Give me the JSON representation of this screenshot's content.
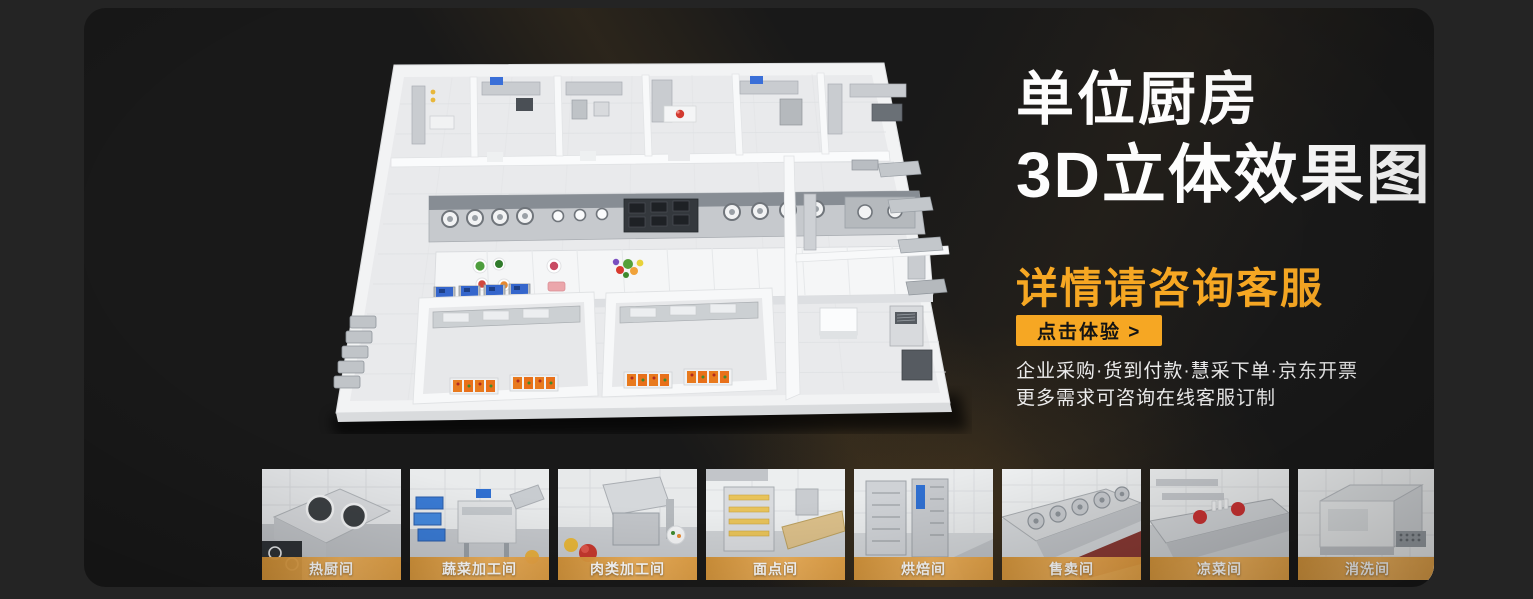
{
  "hero": {
    "title_line1": "单位厨房",
    "title_line2": "3D立体效果图",
    "subtitle": "详情请咨询客服",
    "cta_label": "点击体验 >",
    "info_line1": "企业采购·货到付款·慧采下单·京东开票",
    "info_line2": "更多需求可咨询在线客服订制"
  },
  "rooms": [
    {
      "label": "热厨间"
    },
    {
      "label": "蔬菜加工间"
    },
    {
      "label": "肉类加工间"
    },
    {
      "label": "面点间"
    },
    {
      "label": "烘焙间"
    },
    {
      "label": "售卖间"
    },
    {
      "label": "凉菜间"
    },
    {
      "label": "消洗间"
    }
  ],
  "colors": {
    "accent_orange": "#F6A723",
    "panel_background": "#191919",
    "outer_background": "#242424",
    "cta_text": "#141414",
    "label_band_start": "#D39134",
    "label_band_end": "#F2B054",
    "title_text": "#FDFDFD",
    "body_text": "#ECECEC"
  }
}
